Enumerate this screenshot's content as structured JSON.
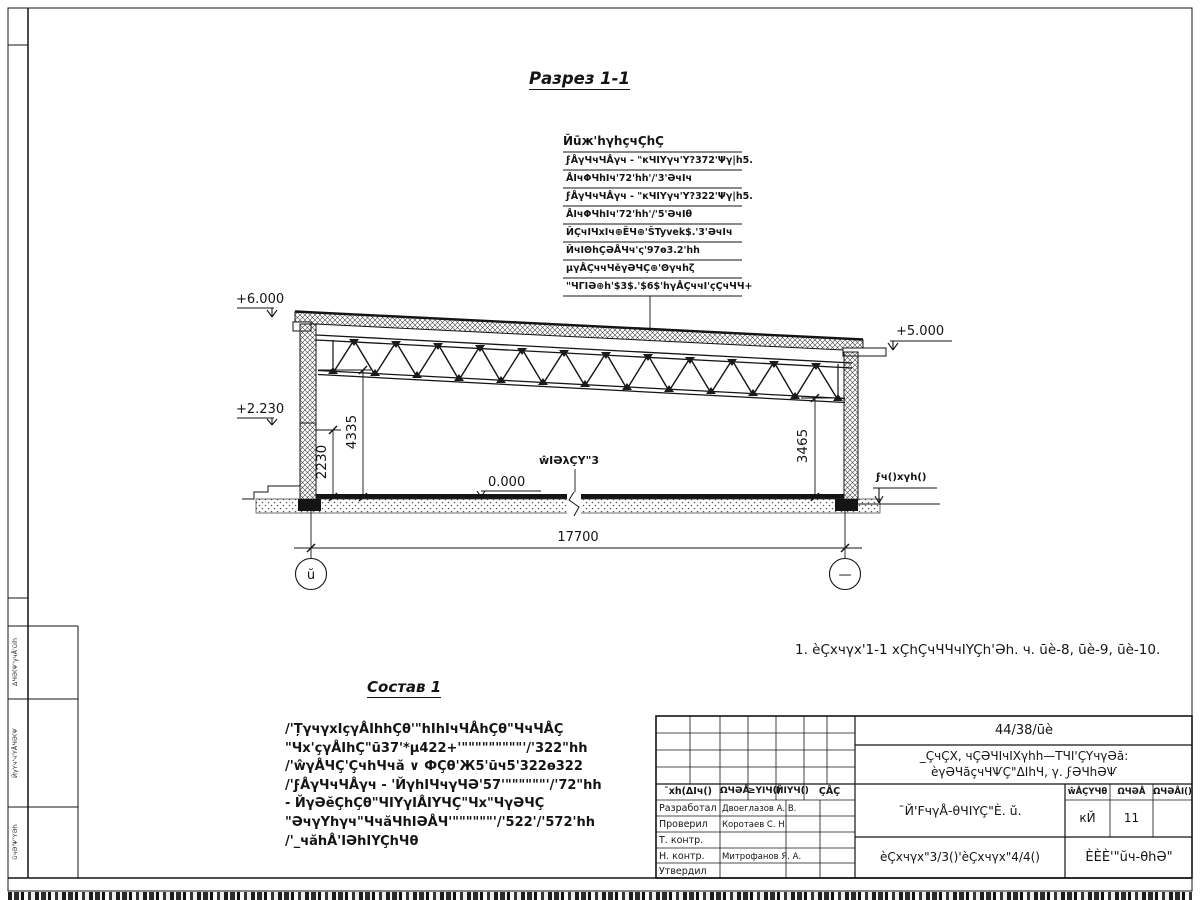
{
  "drawing": {
    "section_title": "Разрез 1-1",
    "roof_callout": {
      "header": "Йūж'hγhçчÇhÇ",
      "rows": [
        "ϝÅγЧчЧÅγч - \"кЧΙYγч'Y?372'Ψγ|h5.",
        "ÅΙчΦЧhΙч'72'hh'/'3'ƏчΙч",
        "ϝÅγЧчЧÅγч - \"кЧΙYγч'Y?322'Ψγ|h5.",
        "ÅΙчΦЧhΙч'72'hh'/'5'ƏчΙθ",
        "ЙÇчΙЧхΙч⊕ЁЧ⊕'ŠTyvek$.'3'ƏчΙч",
        "ЙчΙΘhÇƏÅЧч'ς'97ө3.2'hh",
        "μγÅÇччЧĕγƏЧÇ⊕'Θγчhζ",
        "\"ЧΓΙƏ⊕h'$3$.'$6$'hγÅÇччΙ'çÇчЧЧ+"
      ]
    },
    "elevations": {
      "left_top": "+6.000",
      "left_mid": "+2.230",
      "right_top": "+5.000",
      "floor": "0.000",
      "ground": "ϝч()хγh()"
    },
    "dimensions": {
      "span": "17700",
      "left_inner": "2230",
      "left_outer": "4335",
      "right": "3465"
    },
    "labels": {
      "floor_leader": "ŵΙƏλÇY\"3"
    },
    "axes": {
      "left": "ŭ",
      "right": "—"
    },
    "note": "1. èÇхчγх'1-1 хÇhÇчЧЧчΙYÇh'Əh. ч. ūè-8, ūè-9, ūè-10.",
    "sostav": {
      "title": "Состав 1",
      "lines": [
        "/'ȚγчγхΙçγÅΙhhÇθ'\"hΙhΙчЧÅhÇθ\"ЧчЧÅÇ",
        "\"Чх'çγÅΙhÇ\"ū37'*μ422+'\"\"\"\"\"\"\"\"\"'/'322\"hh",
        "/'ŵγÅЧÇ'ÇчhЧчă ∨ ФÇθ'Ж5'ūч5'322ө322",
        "/'ϝÅγЧчЧÅγч - 'ЙγhΙЧчγЧƏ'57'\"\"\"\"\"\"'/'72\"hh",
        "- ЙγƏĕÇhÇθ\"ЧΙYγΙÅΙYЧÇ\"Чх\"ЧγƏЧÇ",
        "\"ƏчγYhγч\"ЧчăЧhΙƏÅЧ'\"\"\"\"\"\"'/'522'/'572'hh",
        "/'_чăhÅ'ΙƏhΙYÇhЧθ"
      ]
    },
    "margin_stamps": [
      "ΔЧƏ(Ѱ'γчÅ'ŭΙh",
      "ЙγYч'ч'YÅЧƏ(Ѱ",
      "ŭчƏ'Ѱ'YƏh"
    ]
  },
  "title_block": {
    "doc_code": "44/38/ūè",
    "project_line1": "_ÇчÇХ, чÇƏЧΙчΙХγhh—ΤЧΙ'ÇYчγƏă:",
    "project_line2": "èγƏЧăçчЧѰÇ\"ΔΙhЧ, γ. ϝƏЧhƏѰ",
    "rev_headers": [
      "¯хh(ΔΙч()",
      "ΩЧƏÅ",
      "≥YΙЧ()",
      "ЙΙYЧ()",
      "ÇÅÇ"
    ],
    "signatures": [
      {
        "role": "Разработал",
        "name": "Двоеглазов А. В."
      },
      {
        "role": "Проверил",
        "name": "Коротаев С. Н."
      },
      {
        "role": "Т. контр.",
        "name": ""
      },
      {
        "role": "Н. контр.",
        "name": "Митрофанов Я. А."
      },
      {
        "role": "Утвердил",
        "name": ""
      }
    ],
    "sheet_name": "¯Й'FчγÅ-θЧΙYÇ\"È. ŭ.",
    "stage_headers": [
      "ŵÅÇYЧθ",
      "ΩЧƏÅ",
      "ΩЧƏÅΙ()"
    ],
    "stage": "кЙ",
    "sheet_no": "11",
    "sheets_total": "",
    "drawing_ref": "èÇхчγх\"3/3()'èÇхчγх\"4/4()",
    "org": "ÈÈÈ'\"ŭч-θhƏ\""
  }
}
